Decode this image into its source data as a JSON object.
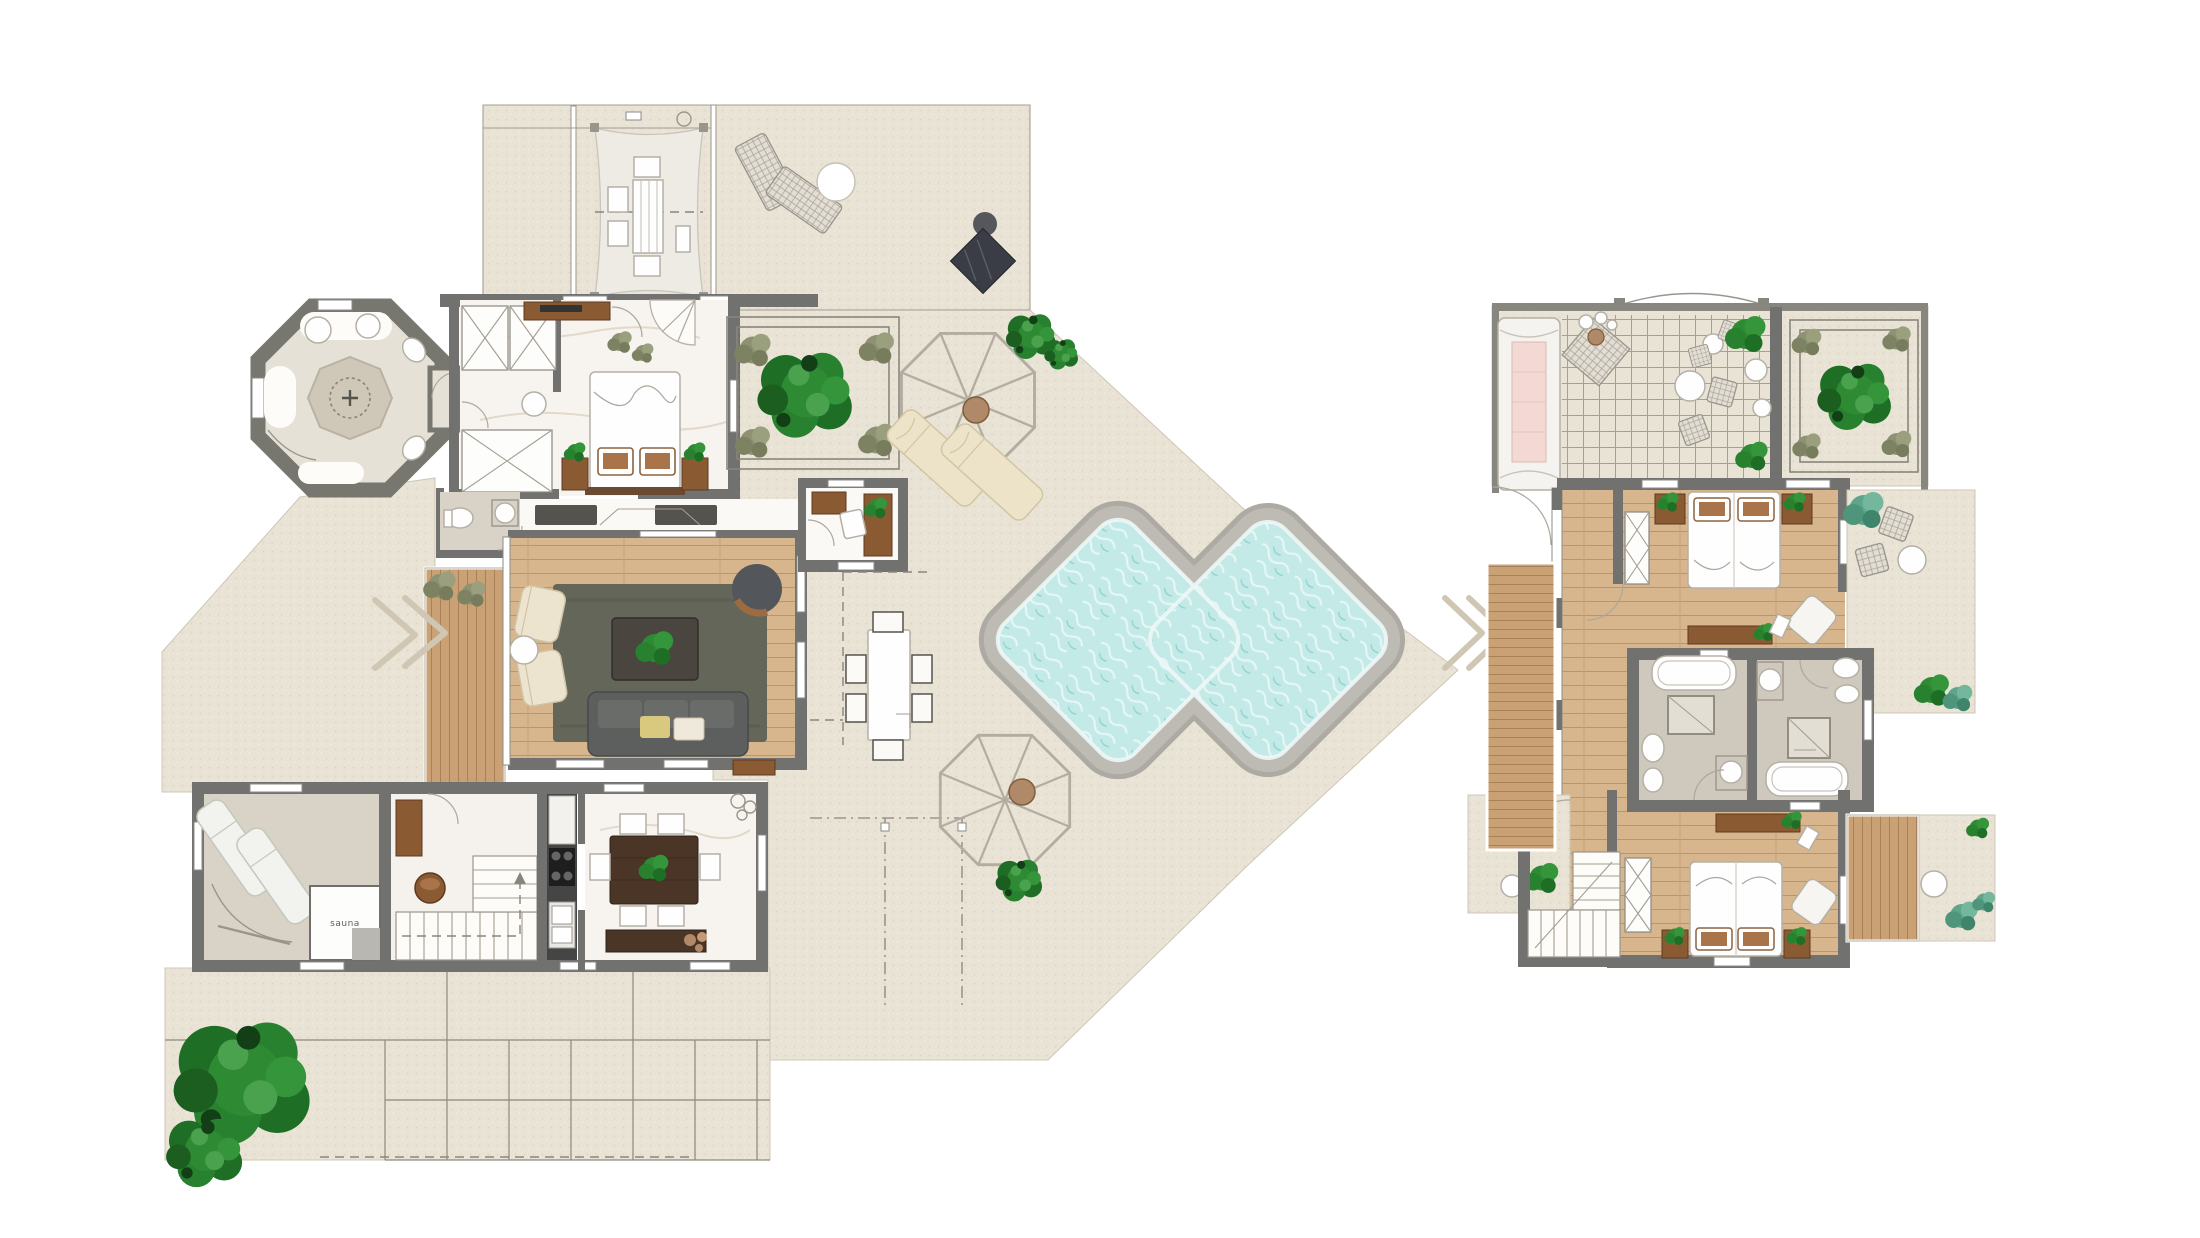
{
  "labels": {
    "sauna": "sauna"
  },
  "colors": {
    "wall": "#71716f",
    "paving": "#e9e3d6",
    "paving_dot": "#dcd3c1",
    "wood_floor": "#d7b58d",
    "deck_wood": "#c9a175",
    "marble": "#f7f4f0",
    "pool_water": "#c4eae8",
    "pool_deck": "#acaaa3",
    "rug": "#64665a",
    "sofa": "#5d5f5e",
    "tree_green": "#2e8b33",
    "bush_olive": "#8d9272",
    "accent_wood": "#8a5a33",
    "cream": "#ece3c9",
    "daybed_pink": "#f3d8d3",
    "dark_slab": "#3a3d45"
  }
}
